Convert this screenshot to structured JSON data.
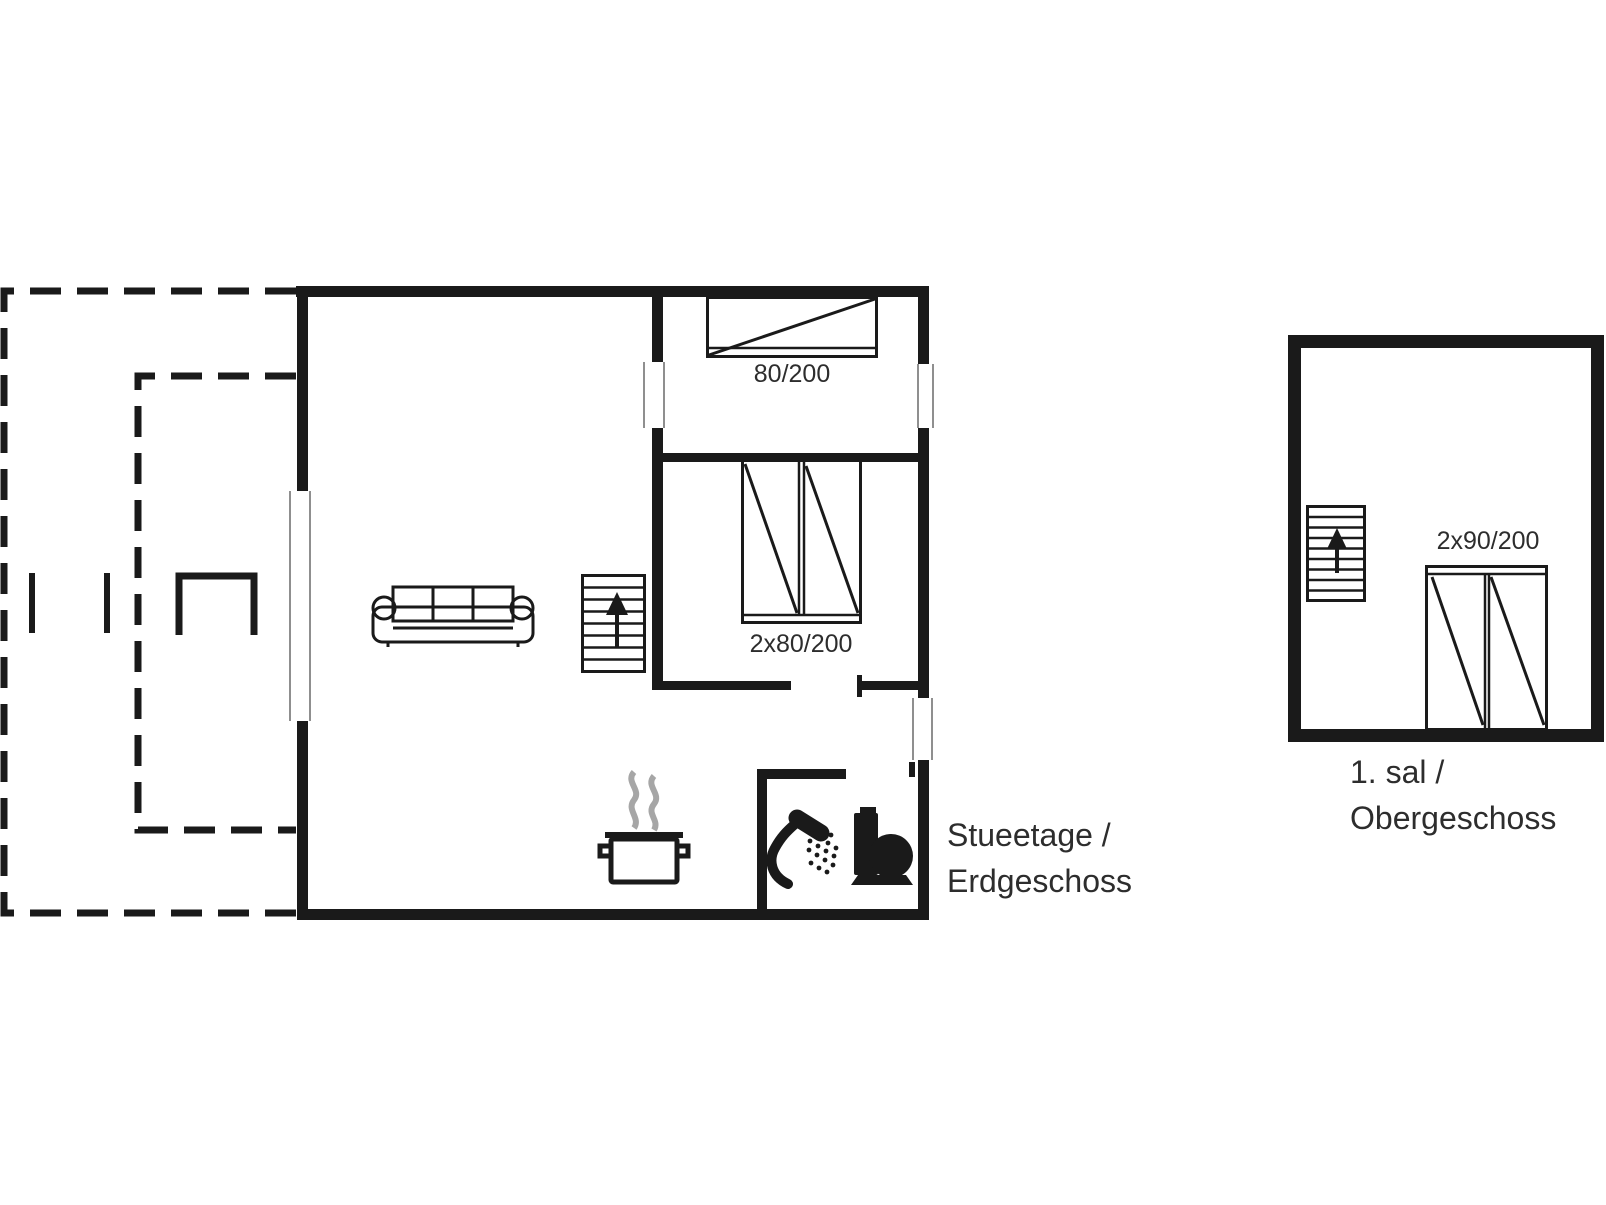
{
  "title": "Holiday house floor plan",
  "colors": {
    "background": "#ffffff",
    "line": "#1a1a1a",
    "text": "#2d2d2d",
    "steam": "#a6a6a6",
    "frame": "#8f8f8f"
  },
  "ground_floor": {
    "bed_single_label": "80/200",
    "bed_double_label": "2x80/200",
    "floor_label_line1": "Stueetage /",
    "floor_label_line2": "Erdgeschoss"
  },
  "upper_floor": {
    "bed_double_label": "2x90/200",
    "floor_label_line1": "1. sal /",
    "floor_label_line2": "Obergeschoss"
  }
}
